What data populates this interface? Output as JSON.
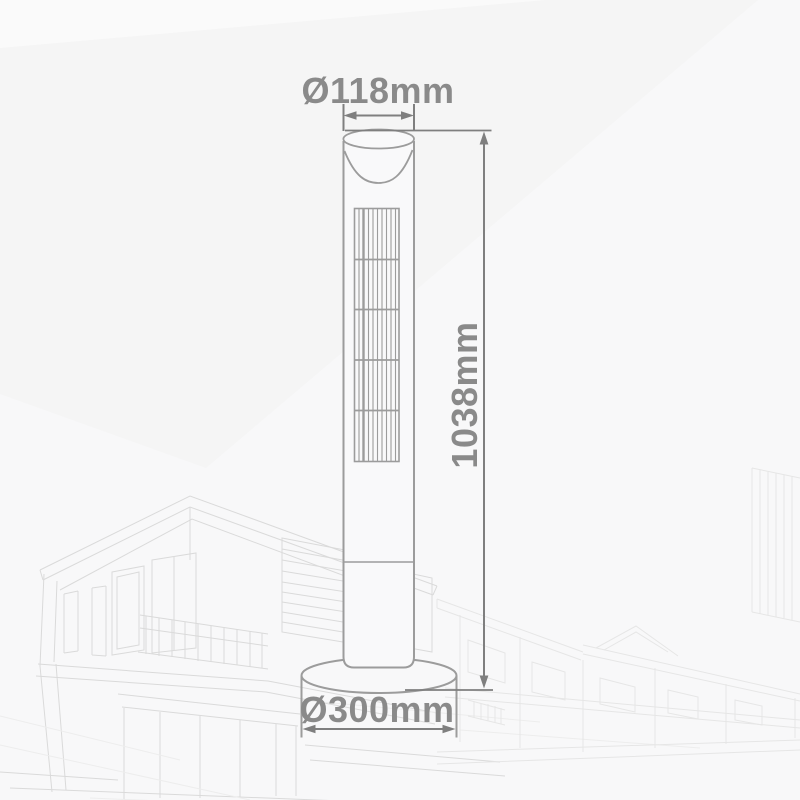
{
  "diagram": {
    "title": "Tower fan dimension drawing",
    "product": "tower-fan",
    "labels": {
      "top_diameter": "Ø118mm",
      "height": "1038mm",
      "base_diameter": "Ø300mm"
    },
    "colors": {
      "background": "#f8f8f9",
      "shade_wedge": "#f2f2f3",
      "dimension_line": "#7f7f7f",
      "dimension_text": "#8a8a8a",
      "product_outline": "#9c9c9c",
      "watermark_line": "#dadada"
    }
  }
}
